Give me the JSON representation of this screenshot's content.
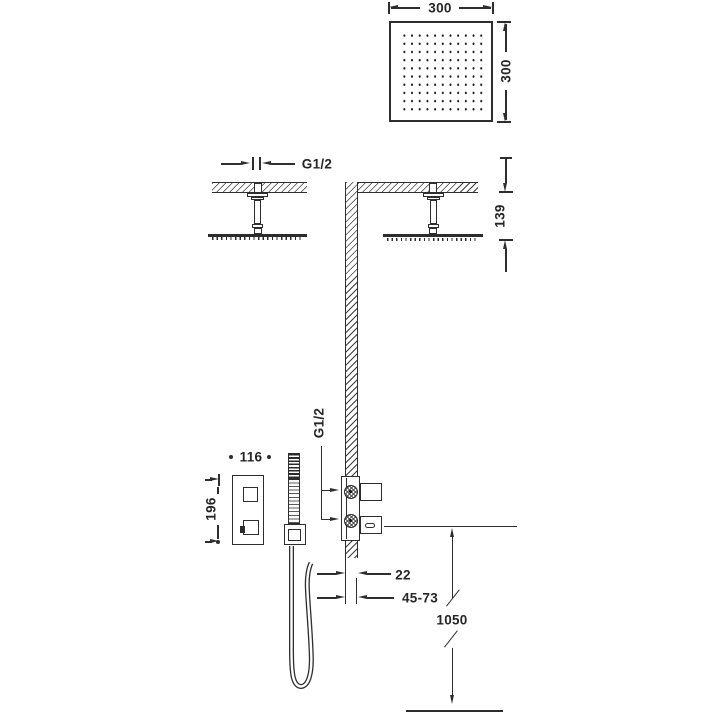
{
  "labels": {
    "head_width": "300",
    "head_height": "300",
    "ceiling_thread": "G1/2",
    "ceiling_drop": "139",
    "valve_thread": "G1/2",
    "mixer_width": "116",
    "mixer_height": "196",
    "valve_wall_offset": "22",
    "valve_depth_range": "45-73",
    "hose_height": "1050"
  },
  "colors": {
    "line": "#2e2e2e",
    "text": "#262626",
    "background": "#ffffff"
  }
}
